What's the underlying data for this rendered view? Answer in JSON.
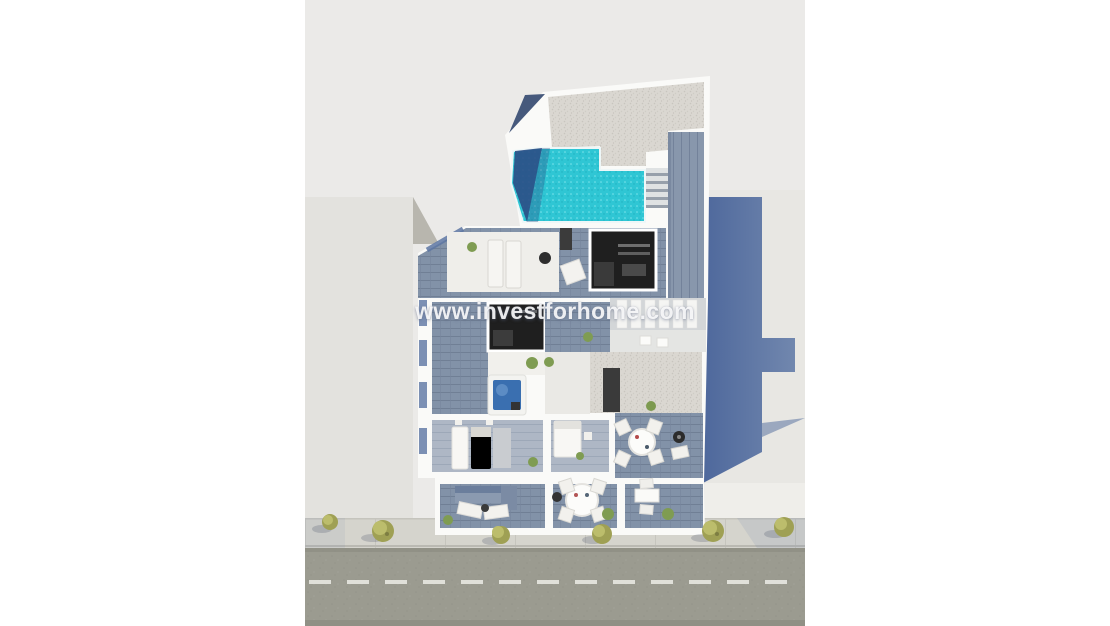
{
  "watermark": {
    "text": "www.investforhome.com"
  },
  "colors": {
    "page_bg": "#ffffff",
    "backdrop": "#ebeae8",
    "wall_white": "#fafaf8",
    "neighbor_left": "#e3e2de",
    "neighbor_left_hip": "#b8b6ae",
    "neighbor_right": "#e8e7e3",
    "cast_shadow": "#5b74a2",
    "gravel": "#dad7d1",
    "pool_water": "#2fc6d4",
    "pool_shadow": "#2b4d85",
    "deck": "#8292a8",
    "deck_light": "#aeb7c5",
    "interior_dark": "#1f1f1f",
    "jacuzzi_water": "#3a6fb0",
    "street": "#9b9b90",
    "sidewalk": "#d5d4cd",
    "tree": "#a9aa5e",
    "road_marking": "#e8e8e2"
  },
  "scene": {
    "type": "aerial-3d-architectural-render",
    "elements": [
      "neighbor-building-left",
      "neighbor-building-right",
      "building-cast-shadow",
      "main-building",
      "rooftop-gravel-roof",
      "swimming-pool",
      "wood-deck-stairs",
      "roof-terrace-sun-loungers",
      "cutaway-bedroom-top",
      "cutaway-bedroom-mid",
      "jacuzzi",
      "closet-room",
      "bedroom-beds",
      "dining-terrace-round-table",
      "balcony-sofa",
      "balcony-dining-table",
      "balcony-side-table",
      "sidewalk-trees",
      "street",
      "street-dashed-line",
      "watermark"
    ]
  }
}
